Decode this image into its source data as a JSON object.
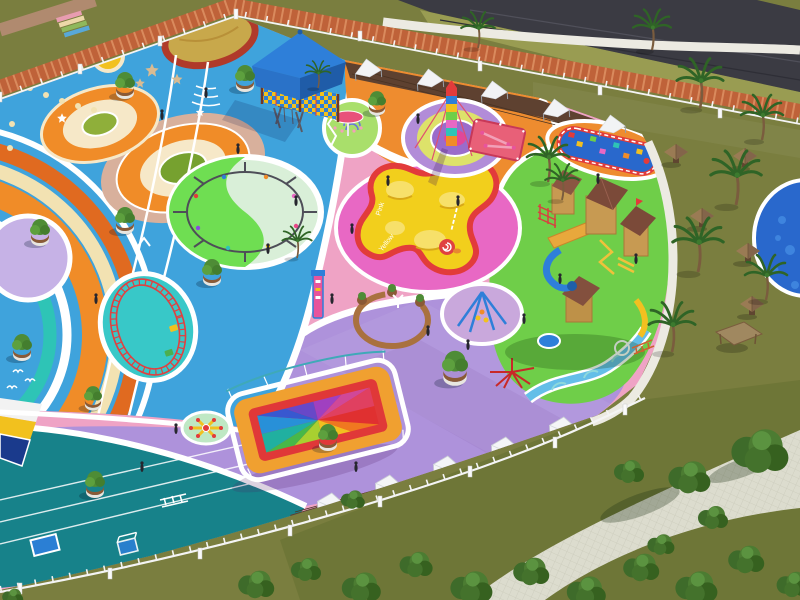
{
  "scene": {
    "type": "3d-architectural-render",
    "view": "aerial-isometric",
    "subject": "Colorful children's playground park with rubberized play zones, sports court, wooden castle, palm garden and lawns"
  },
  "texts": {
    "track_slogan": "JUST DO IT",
    "trampoline_label_1": "Pink",
    "trampoline_label_2": "Yellow"
  },
  "palette": {
    "ground_blue": "#3FA3DC",
    "ground_pink": "#EFA3C5",
    "ground_orange": "#EE8C2F",
    "ground_purple": "#AE92DB",
    "ground_teal": "#17828A",
    "ground_green": "#6FCE49",
    "ground_mint": "#A9DF6B",
    "lawn_green": "#7A7E3F",
    "lawn_light": "#999C52",
    "road_asphalt": "#3B3B43",
    "brick_path": "#BF6239",
    "paver_path": "#DCDCCE",
    "deck_brown": "#5E4130",
    "fence_white": "#F4F4F4",
    "pool_blue": "#2968CC",
    "trampoline_yellow": "#F2CF1C",
    "rim_red": "#E23B3B",
    "canopy_blue": "#2E7FD9",
    "castle_roof": "#7B4A39",
    "castle_wood": "#C79A52",
    "frame_yellow": "#EFC23B",
    "accent_magenta": "#E868C4",
    "ride_teal": "#2EC4B6",
    "arc_orange": "#F08C28",
    "arc_cream": "#F2E2B2"
  },
  "zones": [
    {
      "name": "running-track-zone",
      "surface_color": "#3FA3DC",
      "features": [
        "bullseye circle graphics",
        "orange rainbow arc track",
        "JUST DO IT slogan",
        "star decals",
        "mini train loop"
      ]
    },
    {
      "name": "toddler-zone",
      "surface_color": "#EFA3C5",
      "features": [
        "yellow hill trampoline",
        "magenta disc",
        "bench ring",
        "sign totem",
        "flying-chair spinner"
      ]
    },
    {
      "name": "central-plaza",
      "surface_color": "#EE8C2F",
      "features": [
        "rainbow climbing tower on target circle",
        "seesaw pad",
        "white wavy walkways"
      ]
    },
    {
      "name": "swing-circle",
      "surface_color": "#6FDE52",
      "features": [
        "circular swing carousel on yin-yang circle"
      ]
    },
    {
      "name": "castle-zone",
      "surface_color": "#6FCE49",
      "features": [
        "wooden castle play complex",
        "blue tube slide",
        "striped play pool",
        "small splash pool"
      ]
    },
    {
      "name": "events-lawn",
      "surface_color": "#AE92DB",
      "features": [
        "rainbow trampoline",
        "rope pyramid swing",
        "spider spinner",
        "spoke merry-go-round",
        "water-spray arches"
      ]
    },
    {
      "name": "sports-court",
      "surface_color": "#17828A",
      "features": [
        "soccer goal",
        "training mat",
        "agility ladder",
        "lane lines"
      ]
    },
    {
      "name": "multiuse-court-corner",
      "surface_color": "#1A3A8C",
      "features": [
        "white and yellow border bands"
      ]
    },
    {
      "name": "rest-deck",
      "surface_color": "#5E4130",
      "features": [
        "white shade sails",
        "white folded canopy tents"
      ]
    },
    {
      "name": "palm-garden",
      "surface_color": "#7A7E3F",
      "features": [
        "palm trees",
        "thatched kiosks",
        "picnic shelter",
        "round blue pool",
        "paver promenade"
      ]
    },
    {
      "name": "perimeter",
      "surface_color": "#BF6239",
      "features": [
        "white picket fence",
        "brick path",
        "asphalt road",
        "grass verges"
      ]
    }
  ],
  "equipment": [
    "blue canopy soft-play pavilion",
    "white shade sails",
    "rainbow-striped climbing tower",
    "pink seesaw pad",
    "circular swing carousel",
    "flying-chair spinner",
    "A-frame swings",
    "mini train loop",
    "yellow hill trampoline",
    "wooden bench ring",
    "sign totem",
    "rope pyramid swing",
    "spider spinner",
    "rainbow trampoline",
    "spoke merry-go-round",
    "soccer goal",
    "training mat",
    "agility ladder",
    "wooden castle with slides",
    "blue tube slide",
    "striped play pool",
    "water-spray arches",
    "round pool",
    "thatched kiosks"
  ],
  "vegetation": {
    "palm_trees": 12,
    "planter_seats": 11,
    "bush_clusters": 18,
    "thatched_huts": 5,
    "picnic_shelters": 1
  },
  "people_approx": 20
}
